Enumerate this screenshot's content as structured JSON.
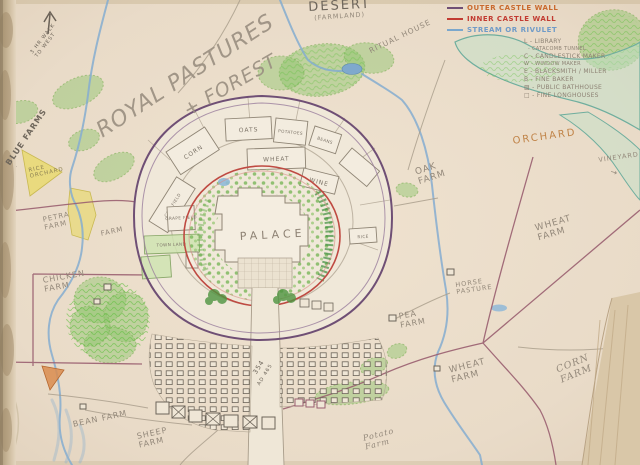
{
  "page": {
    "type": "hand-drawn kingdom map, pencil and colored pencil on cream paper"
  },
  "colors": {
    "paper": "#e9dbc8",
    "outer_wall": "#6f4f75",
    "inner_wall": "#bf4a42",
    "stream": "#85add0",
    "forest_green": "#8cc46a",
    "field_yellow": "#e8d96b",
    "boundary_maroon": "#9a5f70",
    "pencil": "#8d8274",
    "legend_orange": "#c96a2e",
    "legend_red": "#c23b32",
    "legend_blue": "#6f9bc8"
  },
  "compass": {
    "note": "3 HR WALK\nTO WEST"
  },
  "legend": {
    "walls": [
      {
        "label": "OUTER CASTLE WALL"
      },
      {
        "label": "INNER CASTLE WALL"
      },
      {
        "label": "STREAM OR RIVULET"
      }
    ],
    "key": [
      "L - LIBRARY",
      "- CATACOMB TUNNEL",
      "C - CANDLESTICK MAKER",
      "W - WINDOW MAKER",
      "E - BLACKSMITH / MILLER",
      "B - FINE BAKER",
      "▨ - PUBLIC BATHHOUSE",
      "□ - FINE LONGHOUSES"
    ]
  },
  "areas": {
    "royal_pastures": "ROYAL PASTURES",
    "forest": "+ FOREST",
    "desert": "DESERT",
    "desert_sub": "(FARMLAND)",
    "ritual_house": "RITUAL HOUSE",
    "orchard": "ORCHARD",
    "vineyard": "VINEYARD",
    "vineyard_arrow": "→",
    "oak_farm": "OAK\nFARM",
    "wheat_farm_east": "WHEAT\nFARM",
    "horse_pasture": "HORSE\nPASTURE",
    "pea_farm": "PEA\nFARM",
    "wheat_farm_south": "WHEAT\nFARM",
    "corn_farm": "CORN\nFARM",
    "blue_farms": "BLUE FARMS",
    "rice_orchard": "RICE\nORCHARD",
    "petra_farm": "PETRA\nFARM",
    "farm": "FARM",
    "chicken_farm": "CHICKEN\nFARM",
    "bean_farm": "BEAN FARM",
    "sheep_farm": "SHEEP\nFARM",
    "potato_farm": "Potato\nFarm",
    "road_year": "354",
    "road_year2": "AD 465"
  },
  "castle": {
    "palace": "PALACE",
    "plots": {
      "corn": "CORN",
      "oats": "OATS",
      "potatoes": "POTATOES",
      "beans": "BEANS",
      "wheat": "WHEAT",
      "wine": "WINE",
      "rice": "RICE",
      "cow_field": "COW FIELD",
      "grape_field": "GRAPE FIELD",
      "town_land": "TOWN LAND"
    }
  }
}
